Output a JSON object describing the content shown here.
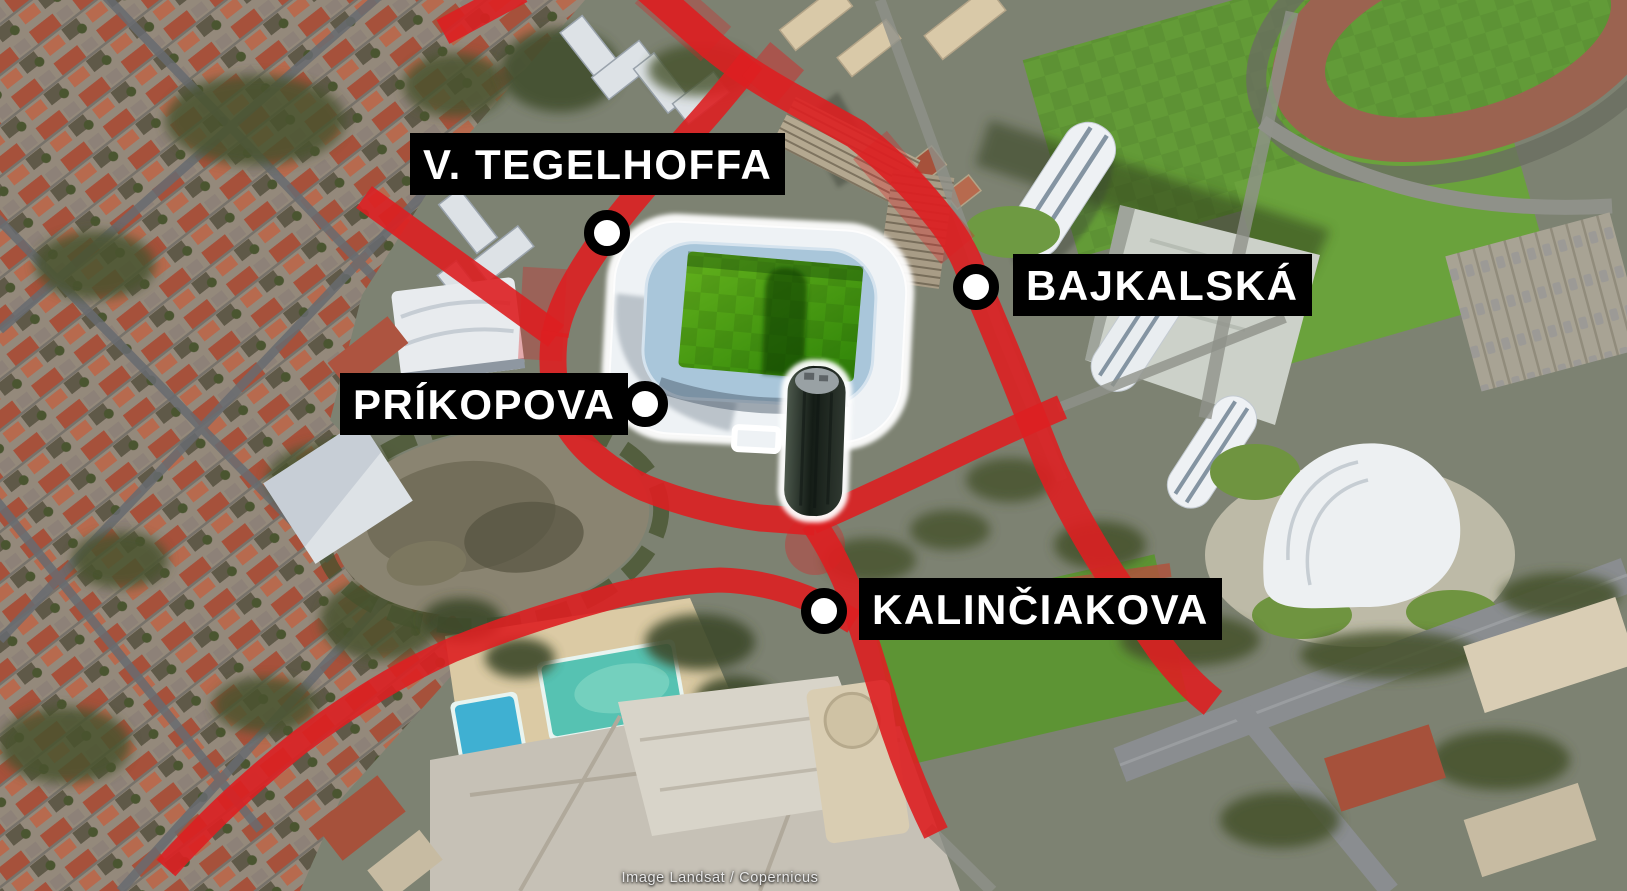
{
  "map": {
    "attribution": "Image Landsat / Copernicus",
    "streets": [
      {
        "name": "V. TEGELHOFFA"
      },
      {
        "name": "BAJKALSKÁ"
      },
      {
        "name": "PRÍKOPOVA"
      },
      {
        "name": "KALINČIAKOVA"
      }
    ],
    "features": [
      "football-stadium-highlighted",
      "stadium-tower",
      "red-road-network",
      "aerial-3d-basemap"
    ],
    "colors": {
      "road_highlight": "#DD1F21",
      "label_background": "#000000",
      "label_text": "#FFFFFF",
      "marker_fill": "#FFFFFF",
      "marker_ring": "#000000",
      "stadium_highlight": "#FFFFFF",
      "pitch_green": "#3F930D"
    }
  }
}
